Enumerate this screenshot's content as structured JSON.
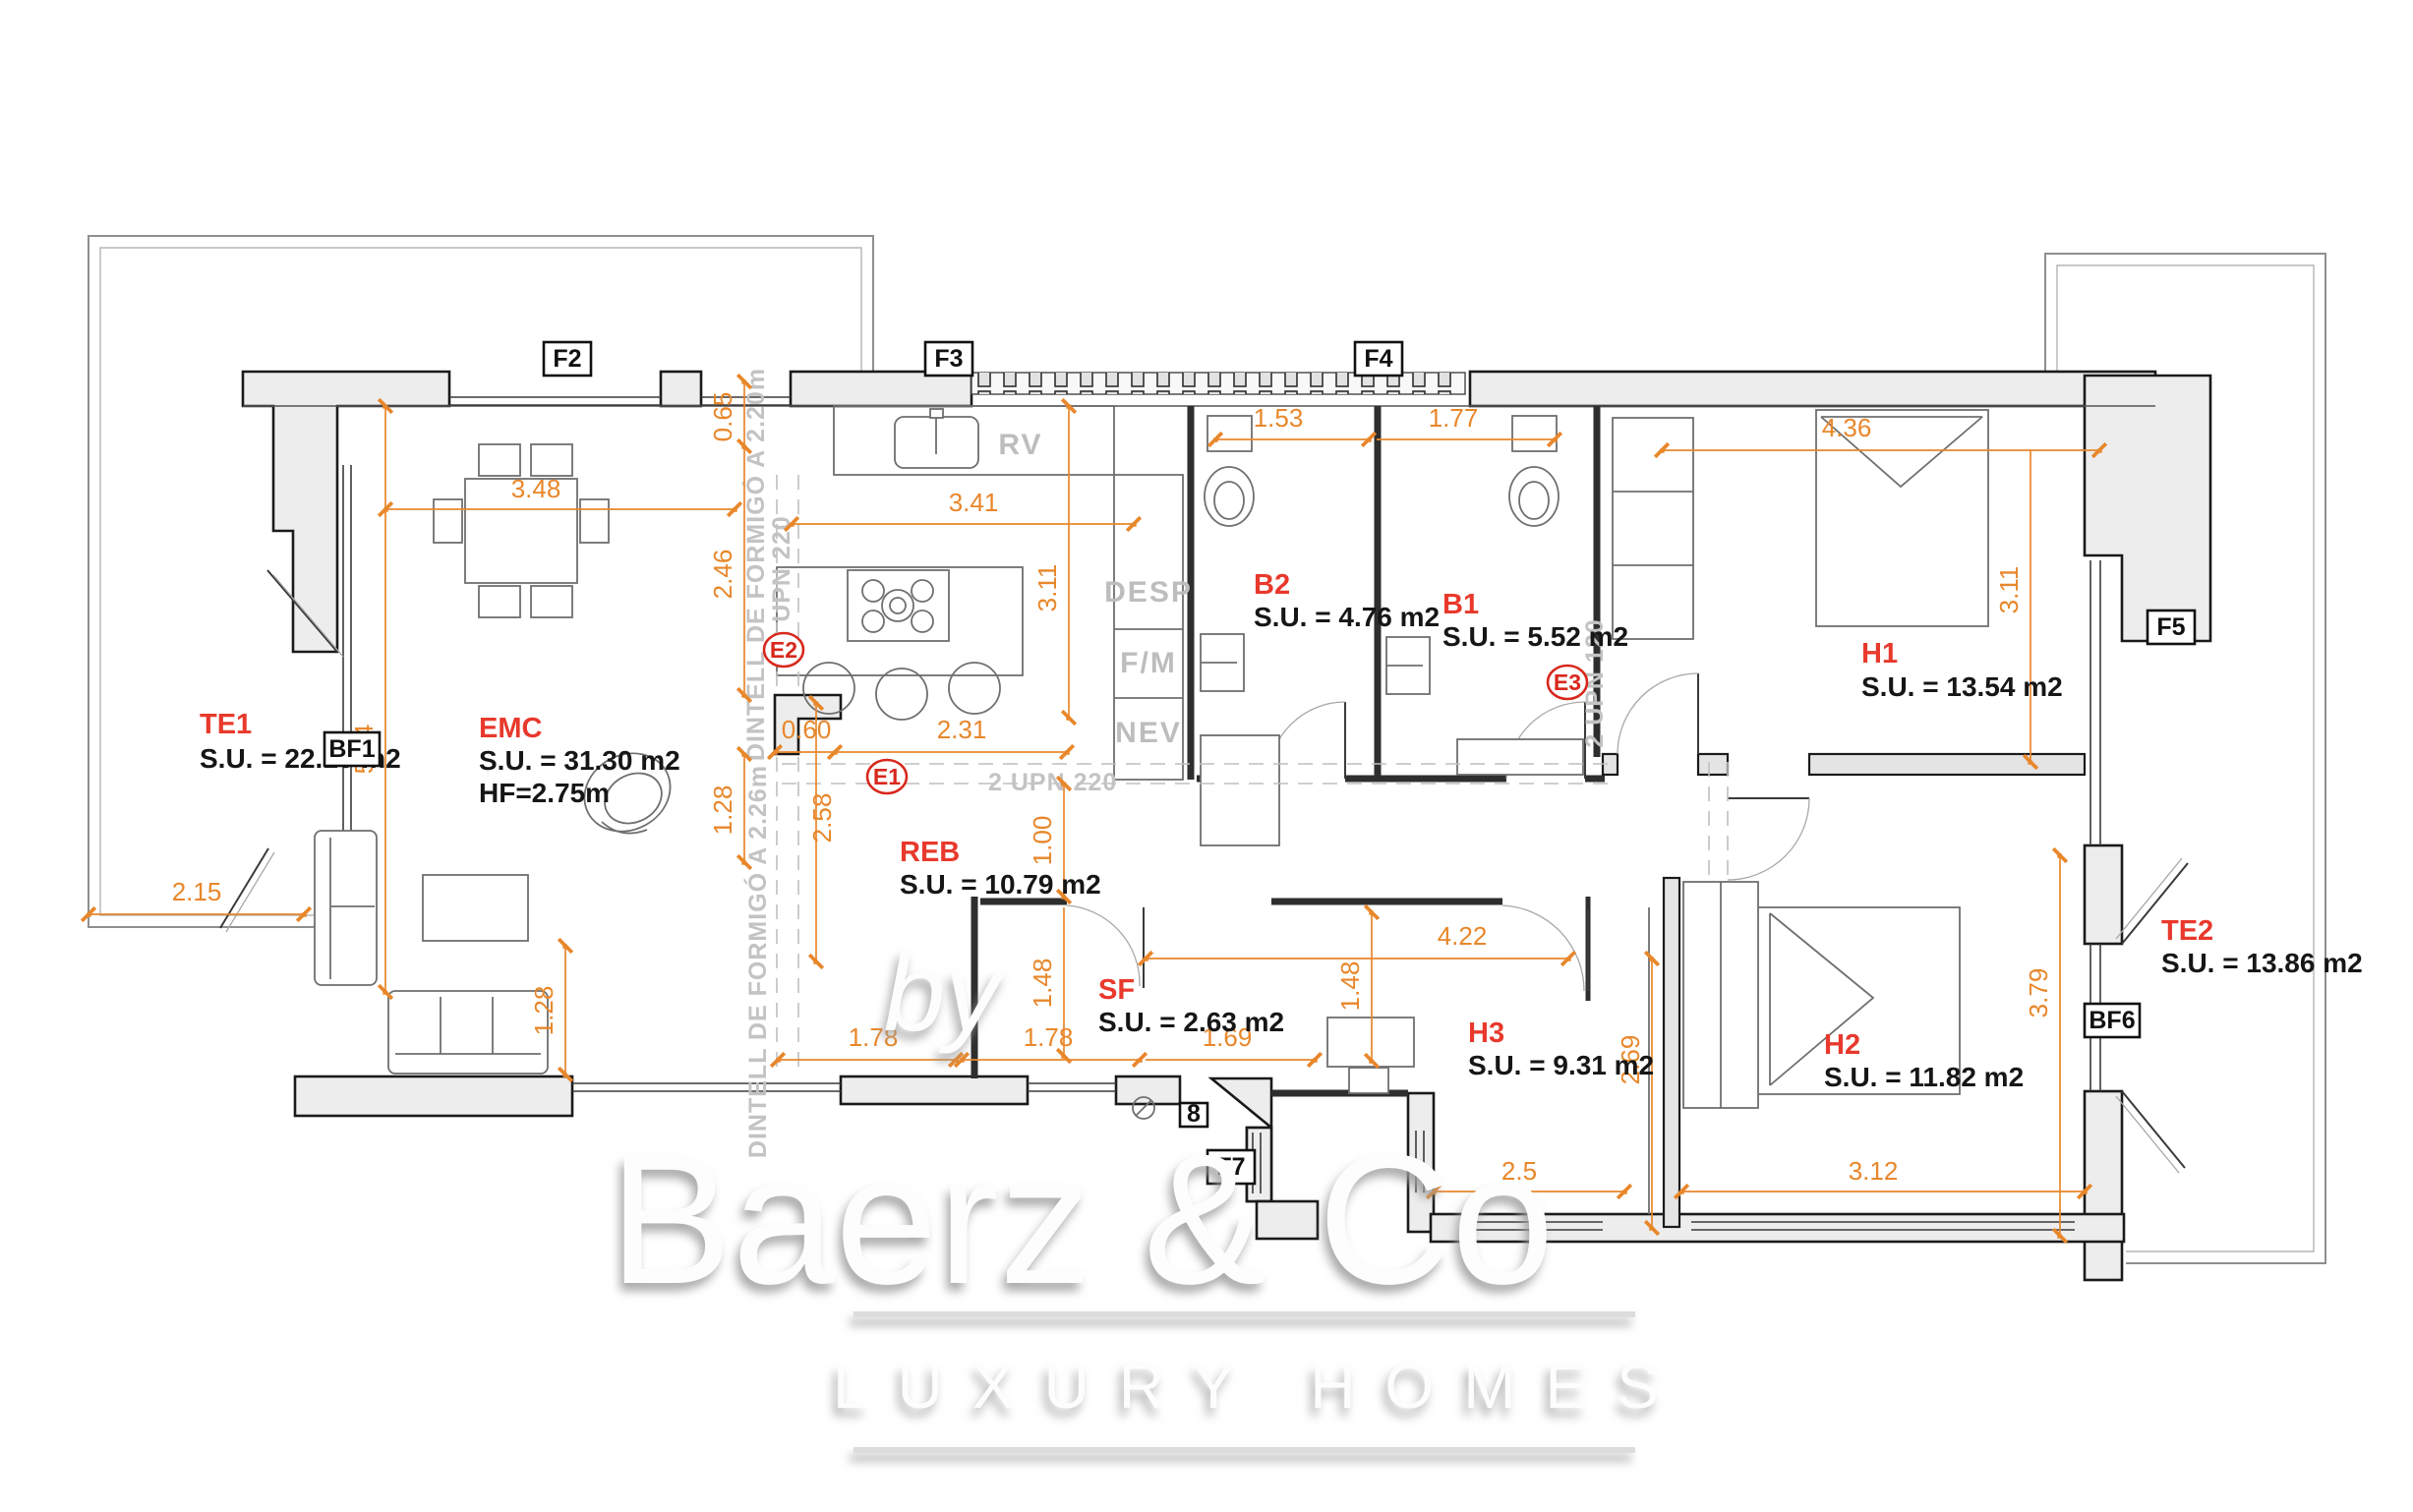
{
  "plan": {
    "rooms": {
      "te1": {
        "name": "TE1",
        "area": "S.U. = 22.10 m2"
      },
      "emc": {
        "name": "EMC",
        "area": "S.U. = 31.30 m2",
        "height": "HF=2.75m"
      },
      "reb": {
        "name": "REB",
        "area": "S.U. = 10.79 m2"
      },
      "sf": {
        "name": "SF",
        "area": "S.U. = 2.63 m2"
      },
      "b2": {
        "name": "B2",
        "area": "S.U. = 4.76 m2"
      },
      "b1": {
        "name": "B1",
        "area": "S.U. = 5.52 m2"
      },
      "h1": {
        "name": "H1",
        "area": "S.U. = 13.54 m2"
      },
      "h2": {
        "name": "H2",
        "area": "S.U. = 11.82 m2"
      },
      "h3": {
        "name": "H3",
        "area": "S.U. = 9.31 m2"
      },
      "te2": {
        "name": "TE2",
        "area": "S.U. = 13.86 m2"
      }
    },
    "facade_labels": {
      "f2": "F2",
      "f3": "F3",
      "f4": "F4",
      "f5": "F5",
      "f7": "F7",
      "bf1": "BF1",
      "bf6": "BF6",
      "n8": "8"
    },
    "beam_markers": {
      "e1": "E1",
      "e2": "E2",
      "e3": "E3"
    },
    "beam_notes": {
      "upn220_h": "2 UPN 220",
      "upn220_v": "2 UPN 220",
      "upn120_v": "2 UPN 120",
      "dintell220": "DINTELL DE FORMIGÓ A 2.20m",
      "dintell226": "DINTELL DE FORMIGÓ A 2.26m"
    },
    "appliances": {
      "rv": "RV",
      "desp": "DESP",
      "fm": "F/M",
      "nev": "NEV"
    },
    "dims": {
      "d_348": "3.48",
      "d_065": "0.65",
      "d_246": "2.46",
      "d_584": "5.84",
      "d_215": "2.15",
      "d_128a": "1.28",
      "d_128b": "1.28",
      "d_258": "2.58",
      "d_060": "0.60",
      "d_231": "2.31",
      "d_341": "3.41",
      "d_311a": "3.11",
      "d_153": "1.53",
      "d_177": "1.77",
      "d_436": "4.36",
      "d_311b": "3.11",
      "d_100": "1.00",
      "d_148a": "1.48",
      "d_148b": "1.48",
      "d_178a": "1.78",
      "d_178b": "1.78",
      "d_169": "1.69",
      "d_422": "4.22",
      "d_269": "2.69",
      "d_25": "2.5",
      "d_312": "3.12",
      "d_379": "3.79"
    }
  },
  "watermark": {
    "by": "by",
    "brand": "Baerz & Co",
    "tagline": "LUXURY HOMES"
  },
  "colors": {
    "dimension": "#E8872B",
    "room_name": "#E8392C",
    "wall_fill": "#EDEDED",
    "note_gray": "#BDBDBD",
    "marker_red": "#D8281C"
  }
}
